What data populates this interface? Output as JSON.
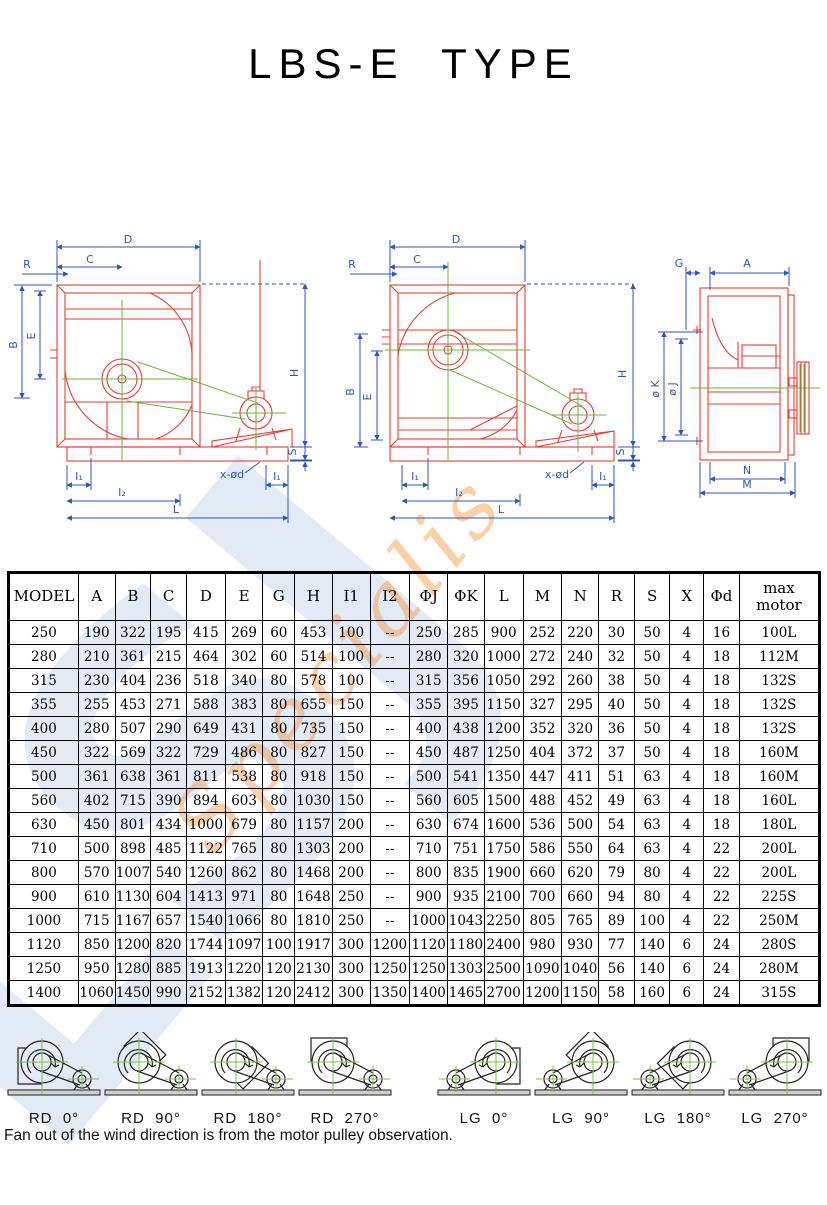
{
  "title": "LBS-E  TYPE",
  "watermark": {
    "letters": "LSJ",
    "script": "Specialis"
  },
  "drawings": {
    "labels": {
      "D": "D",
      "C": "C",
      "R": "R",
      "B": "B",
      "E": "E",
      "H": "H",
      "S": "S",
      "I1": "I₁",
      "I2": "I₂",
      "L": "L",
      "xod": "x-ød",
      "G": "G",
      "A": "A",
      "oK": "ø K",
      "oJ": "ø J",
      "N": "N",
      "M": "M"
    }
  },
  "table": {
    "headers": [
      "MODEL",
      "A",
      "B",
      "C",
      "D",
      "E",
      "G",
      "H",
      "I1",
      "I2",
      "ΦJ",
      "ΦK",
      "L",
      "M",
      "N",
      "R",
      "S",
      "X",
      "Φd",
      "max motor"
    ],
    "rows": [
      [
        "250",
        "190",
        "322",
        "195",
        "415",
        "269",
        "60",
        "453",
        "100",
        "--",
        "250",
        "285",
        "900",
        "252",
        "220",
        "30",
        "50",
        "4",
        "16",
        "100L"
      ],
      [
        "280",
        "210",
        "361",
        "215",
        "464",
        "302",
        "60",
        "514",
        "100",
        "--",
        "280",
        "320",
        "1000",
        "272",
        "240",
        "32",
        "50",
        "4",
        "18",
        "112M"
      ],
      [
        "315",
        "230",
        "404",
        "236",
        "518",
        "340",
        "80",
        "578",
        "100",
        "--",
        "315",
        "356",
        "1050",
        "292",
        "260",
        "38",
        "50",
        "4",
        "18",
        "132S"
      ],
      [
        "355",
        "255",
        "453",
        "271",
        "588",
        "383",
        "80",
        "655",
        "150",
        "--",
        "355",
        "395",
        "1150",
        "327",
        "295",
        "40",
        "50",
        "4",
        "18",
        "132S"
      ],
      [
        "400",
        "280",
        "507",
        "290",
        "649",
        "431",
        "80",
        "735",
        "150",
        "--",
        "400",
        "438",
        "1200",
        "352",
        "320",
        "36",
        "50",
        "4",
        "18",
        "132S"
      ],
      [
        "450",
        "322",
        "569",
        "322",
        "729",
        "486",
        "80",
        "827",
        "150",
        "--",
        "450",
        "487",
        "1250",
        "404",
        "372",
        "37",
        "50",
        "4",
        "18",
        "160M"
      ],
      [
        "500",
        "361",
        "638",
        "361",
        "811",
        "538",
        "80",
        "918",
        "150",
        "--",
        "500",
        "541",
        "1350",
        "447",
        "411",
        "51",
        "63",
        "4",
        "18",
        "160M"
      ],
      [
        "560",
        "402",
        "715",
        "390",
        "894",
        "603",
        "80",
        "1030",
        "150",
        "--",
        "560",
        "605",
        "1500",
        "488",
        "452",
        "49",
        "63",
        "4",
        "18",
        "160L"
      ],
      [
        "630",
        "450",
        "801",
        "434",
        "1000",
        "679",
        "80",
        "1157",
        "200",
        "--",
        "630",
        "674",
        "1600",
        "536",
        "500",
        "54",
        "63",
        "4",
        "18",
        "180L"
      ],
      [
        "710",
        "500",
        "898",
        "485",
        "1122",
        "765",
        "80",
        "1303",
        "200",
        "--",
        "710",
        "751",
        "1750",
        "586",
        "550",
        "64",
        "63",
        "4",
        "22",
        "200L"
      ],
      [
        "800",
        "570",
        "1007",
        "540",
        "1260",
        "862",
        "80",
        "1468",
        "200",
        "--",
        "800",
        "835",
        "1900",
        "660",
        "620",
        "79",
        "80",
        "4",
        "22",
        "200L"
      ],
      [
        "900",
        "610",
        "1130",
        "604",
        "1413",
        "971",
        "80",
        "1648",
        "250",
        "--",
        "900",
        "935",
        "2100",
        "700",
        "660",
        "94",
        "80",
        "4",
        "22",
        "225S"
      ],
      [
        "1000",
        "715",
        "1167",
        "657",
        "1540",
        "1066",
        "80",
        "1810",
        "250",
        "--",
        "1000",
        "1043",
        "2250",
        "805",
        "765",
        "89",
        "100",
        "4",
        "22",
        "250M"
      ],
      [
        "1120",
        "850",
        "1200",
        "820",
        "1744",
        "1097",
        "100",
        "1917",
        "300",
        "1200",
        "1120",
        "1180",
        "2400",
        "980",
        "930",
        "77",
        "140",
        "6",
        "24",
        "280S"
      ],
      [
        "1250",
        "950",
        "1280",
        "885",
        "1913",
        "1220",
        "120",
        "2130",
        "300",
        "1250",
        "1250",
        "1303",
        "2500",
        "1090",
        "1040",
        "56",
        "140",
        "6",
        "24",
        "280M"
      ],
      [
        "1400",
        "1060",
        "1450",
        "990",
        "2152",
        "1382",
        "120",
        "2412",
        "300",
        "1350",
        "1400",
        "1465",
        "2700",
        "1200",
        "1150",
        "58",
        "160",
        "6",
        "24",
        "315S"
      ]
    ]
  },
  "diagrams": {
    "items": [
      {
        "label": "RD  0°",
        "angle": 270,
        "mirror": false,
        "gap_before": false
      },
      {
        "label": "RD  90°",
        "angle": 45,
        "mirror": false,
        "gap_before": false
      },
      {
        "label": "RD  180°",
        "angle": 135,
        "mirror": false,
        "gap_before": false
      },
      {
        "label": "RD  270°",
        "angle": 0,
        "mirror": false,
        "gap_before": false
      },
      {
        "label": "LG  0°",
        "angle": 270,
        "mirror": true,
        "gap_before": true
      },
      {
        "label": "LG  90°",
        "angle": 45,
        "mirror": true,
        "gap_before": false
      },
      {
        "label": "LG  180°",
        "angle": 135,
        "mirror": true,
        "gap_before": false
      },
      {
        "label": "LG  270°",
        "angle": 0,
        "mirror": true,
        "gap_before": false
      }
    ]
  },
  "footer": "Fan out of the wind direction is from the motor pulley observation."
}
